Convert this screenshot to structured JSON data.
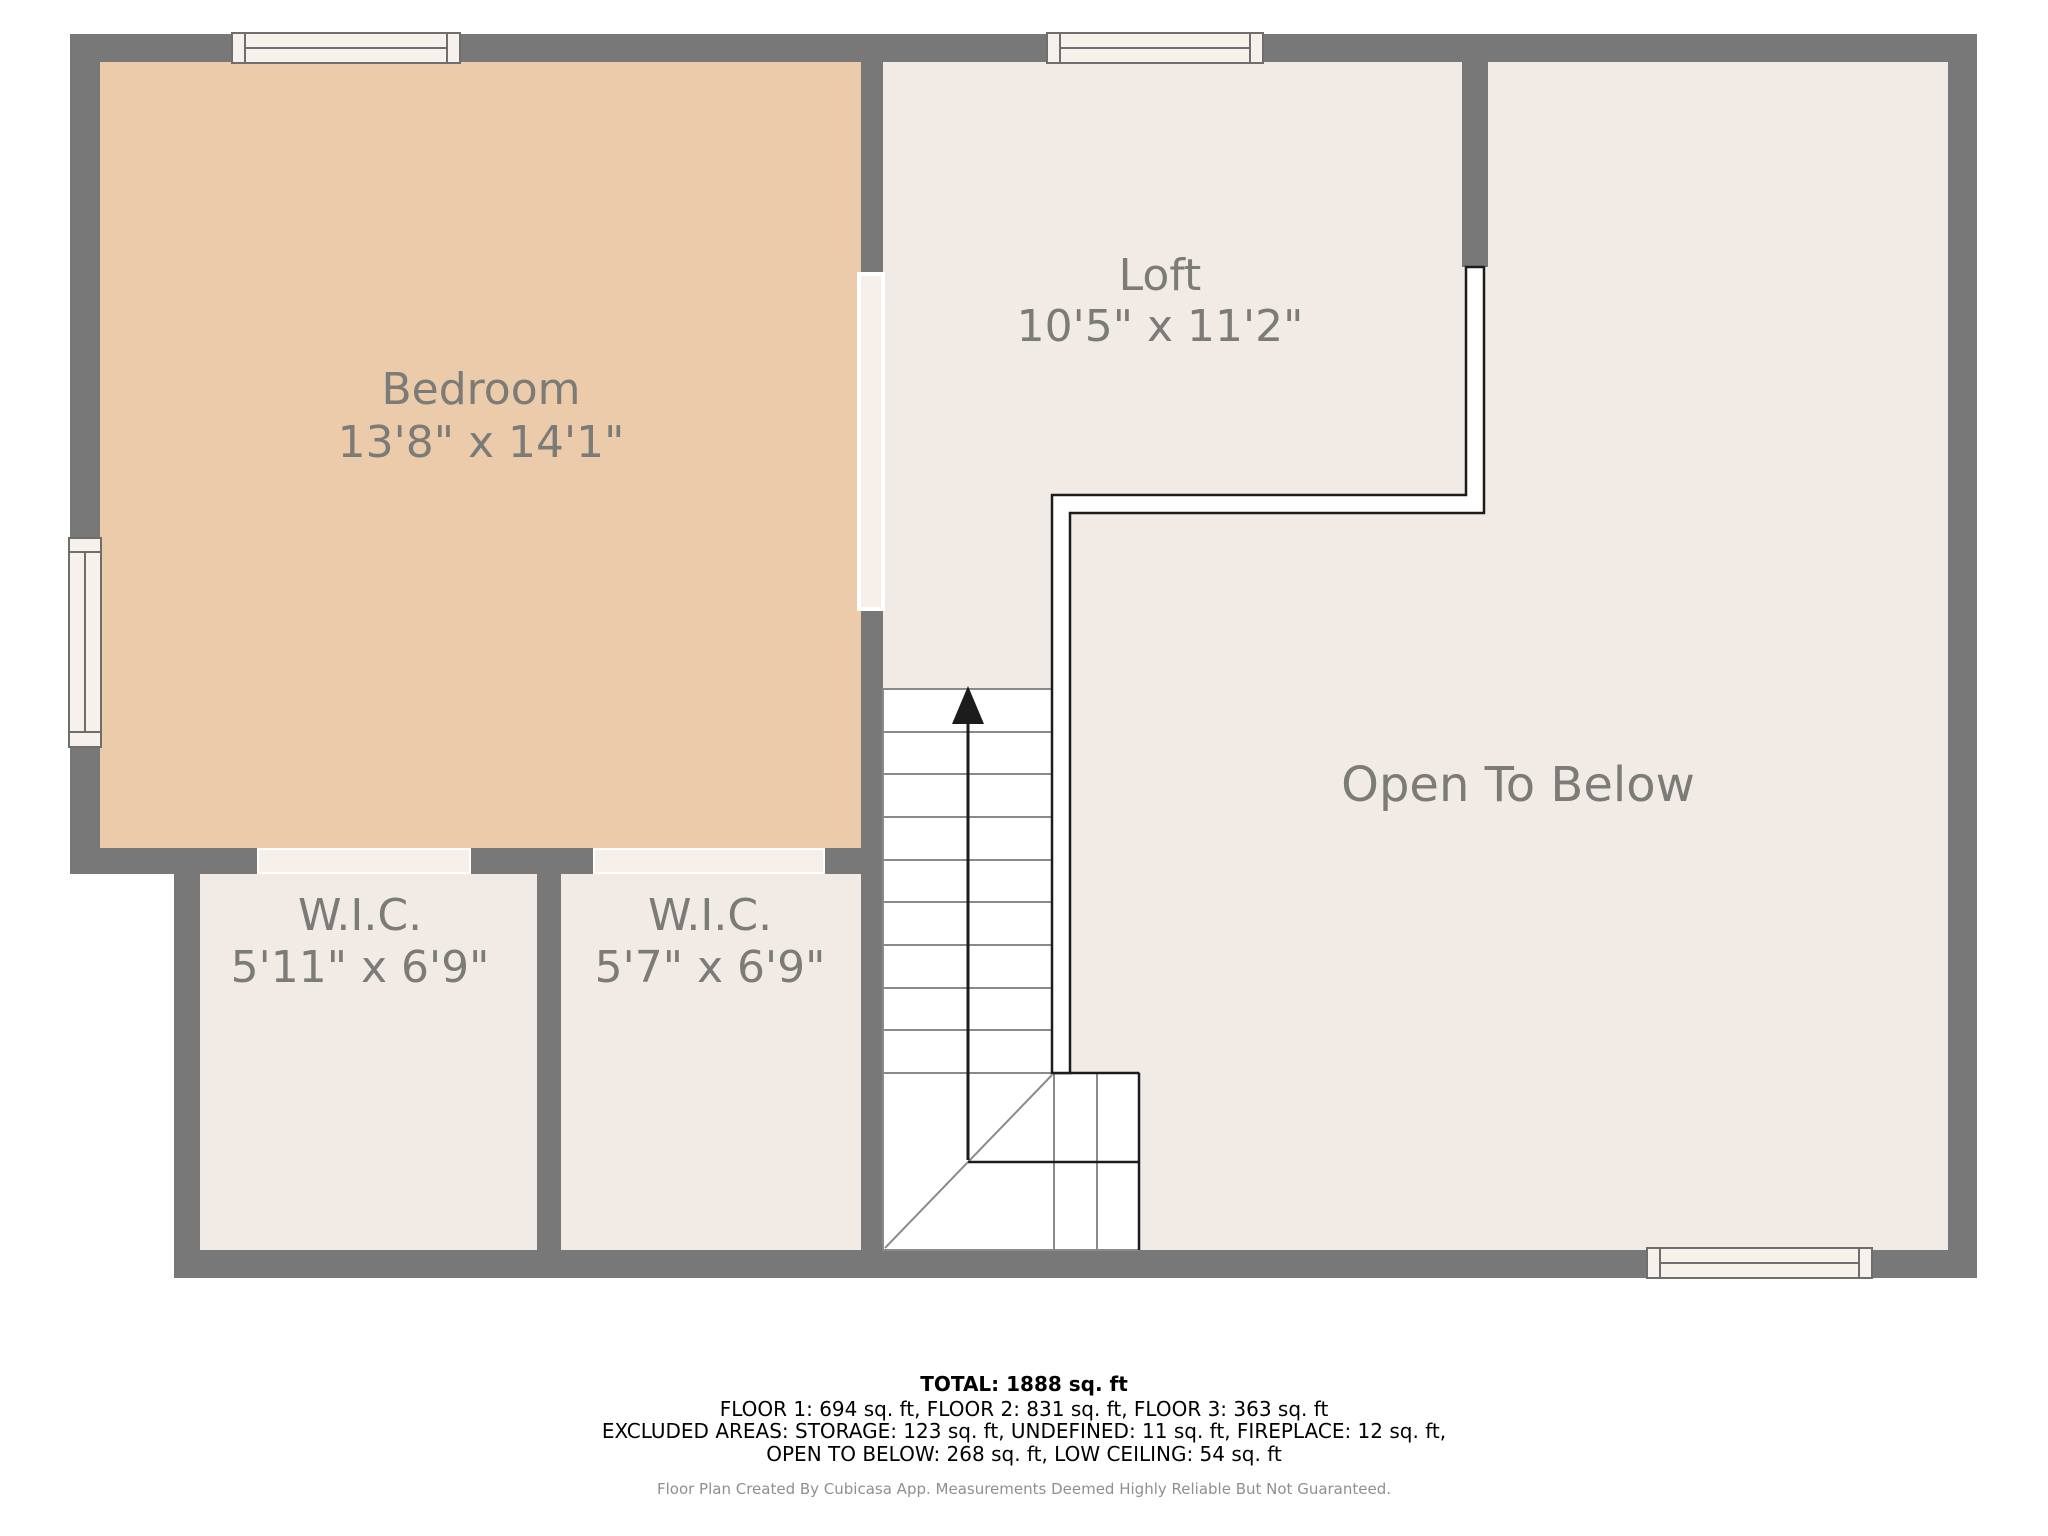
{
  "plan": {
    "rooms": {
      "bedroom": {
        "label": "Bedroom",
        "dims": "13'8\" x 14'1\""
      },
      "loft": {
        "label": "Loft",
        "dims": "10'5\" x 11'2\""
      },
      "open_to_below": {
        "label": "Open To Below"
      },
      "wic_left": {
        "label": "W.I.C.",
        "dims": "5'11\" x 6'9\""
      },
      "wic_right": {
        "label": "W.I.C.",
        "dims": "5'7\" x 6'9\""
      }
    },
    "colors": {
      "wall": "#787878",
      "bedroom_fill": "#ebcba9",
      "floor_fill": "#f2ebe5",
      "opening_fill": "#f7efe9",
      "window_fill": "#f7f1eb",
      "label_text": "#7b7b78",
      "railing": "#1c1c1c",
      "stair_line": "#8a8a8a"
    }
  },
  "footer": {
    "total": "TOTAL: 1888 sq. ft",
    "floors": "FLOOR 1: 694 sq. ft, FLOOR 2: 831 sq. ft, FLOOR 3: 363 sq. ft",
    "excluded_1": "EXCLUDED AREAS: STORAGE: 123 sq. ft, UNDEFINED: 11 sq. ft, FIREPLACE: 12 sq. ft,",
    "excluded_2": "OPEN TO BELOW: 268 sq. ft, LOW CEILING: 54 sq. ft",
    "credit": "Floor Plan Created By Cubicasa App. Measurements Deemed Highly Reliable But Not Guaranteed."
  }
}
